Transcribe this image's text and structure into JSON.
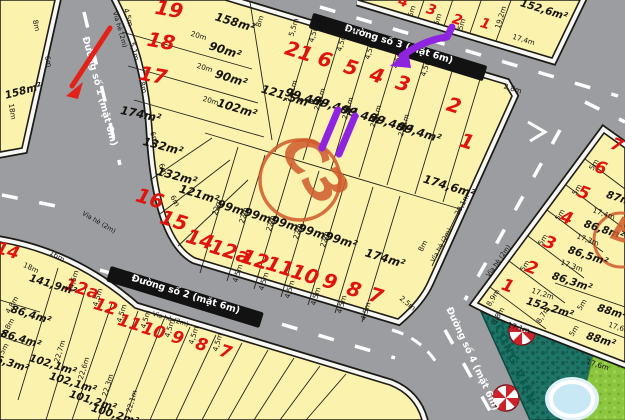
{
  "map_title": "land subdivision plot map",
  "roads": {
    "road1": "Đường số 1 (mặt 6m)",
    "road2": "Đường số 2 (mặt 6m)",
    "road3": "Đường số 3 (mặt 6m)",
    "road4": "Đường số 4 (mặt 6m)",
    "sidewalk": "Vỉa hè (2m)"
  },
  "blocks": {
    "main_block": {
      "label": "C3",
      "plot_numbers": [
        "19",
        "18",
        "17",
        "21",
        "6",
        "5",
        "4",
        "3",
        "2",
        "1",
        "16",
        "15",
        "14",
        "12a",
        "12",
        "11",
        "10",
        "9",
        "8",
        "7"
      ],
      "areas": [
        "158m²",
        "90m²",
        "90m²",
        "102m²",
        "121,5m²",
        "174m²",
        "132m²",
        "132m²",
        "121m²",
        "99,4m²",
        "99,4m²",
        "99,4m²",
        "99,4m²",
        "99,4m²",
        "99m²",
        "99m²",
        "99m²",
        "99m²",
        "99m²",
        "174,6m²",
        "174m²"
      ]
    },
    "block_b": {
      "label": "B",
      "plot_numbers": [
        "7",
        "6",
        "5",
        "4",
        "3",
        "2",
        "1"
      ],
      "areas": [
        "87m²",
        "86,8m²",
        "86,5m²",
        "86,3m²",
        "152,2m²",
        "88m²",
        "88m²"
      ]
    },
    "top_right_block": {
      "plot_numbers": [
        "4",
        "3",
        "2",
        "1"
      ],
      "areas": [
        "152,6m²"
      ]
    },
    "bottom_left_block": {
      "plot_numbers": [
        "14",
        "12a",
        "12",
        "11",
        "10",
        "9",
        "8",
        "7"
      ],
      "areas": [
        "141,9m²",
        "86,4m²",
        "86,4m²",
        "86,3m²",
        "102,1m²",
        "102,1m²",
        "101,2m²",
        "100,2m²"
      ]
    },
    "far_left_block": {
      "areas": [
        "158m²"
      ]
    }
  },
  "park": {
    "name": "CÔNG VIÊN",
    "features": [
      "swimming-pool",
      "parasol",
      "parasol"
    ]
  },
  "annotations": [
    "purple-arrow",
    "purple-double-stroke",
    "red-road-arrow"
  ],
  "colors": {
    "plot_fill": "#faf2ad",
    "road": "#9b9da0",
    "plot_number": "#df140e",
    "block_circle": "#cf5b2c",
    "annotation_purple": "#8e24e0",
    "annotation_red": "#e32119",
    "park_teal": "#1e7466",
    "grass": "#8cc63e",
    "pool": "#c9e8f6"
  },
  "labels": [
    {
      "t": "19",
      "x": 168,
      "y": 16,
      "r": 10,
      "c": "num"
    },
    {
      "t": "18",
      "x": 160,
      "y": 48,
      "r": 10,
      "c": "num"
    },
    {
      "t": "17",
      "x": 152,
      "y": 82,
      "r": 10,
      "c": "num"
    },
    {
      "t": "21",
      "x": 297,
      "y": 58,
      "r": 17,
      "c": "num"
    },
    {
      "t": "6",
      "x": 323,
      "y": 66,
      "r": 17,
      "c": "num"
    },
    {
      "t": "5",
      "x": 349,
      "y": 74,
      "r": 17,
      "c": "num"
    },
    {
      "t": "4",
      "x": 375,
      "y": 82,
      "r": 17,
      "c": "num"
    },
    {
      "t": "3",
      "x": 401,
      "y": 90,
      "r": 17,
      "c": "num"
    },
    {
      "t": "2",
      "x": 452,
      "y": 112,
      "r": 17,
      "c": "num"
    },
    {
      "t": "1",
      "x": 465,
      "y": 148,
      "r": 17,
      "c": "num"
    },
    {
      "t": "16",
      "x": 148,
      "y": 205,
      "r": 17,
      "c": "num"
    },
    {
      "t": "15",
      "x": 172,
      "y": 227,
      "r": 17,
      "c": "num"
    },
    {
      "t": "14",
      "x": 198,
      "y": 246,
      "r": 17,
      "c": "num"
    },
    {
      "t": "12a",
      "x": 228,
      "y": 258,
      "r": 17,
      "c": "num"
    },
    {
      "t": "12",
      "x": 253,
      "y": 266,
      "r": 17,
      "c": "num"
    },
    {
      "t": "11",
      "x": 278,
      "y": 273,
      "r": 17,
      "c": "num"
    },
    {
      "t": "10",
      "x": 303,
      "y": 281,
      "r": 17,
      "c": "num"
    },
    {
      "t": "9",
      "x": 328,
      "y": 288,
      "r": 17,
      "c": "num"
    },
    {
      "t": "8",
      "x": 352,
      "y": 296,
      "r": 17,
      "c": "num"
    },
    {
      "t": "7",
      "x": 374,
      "y": 302,
      "r": 17,
      "c": "num"
    },
    {
      "t": "158m²",
      "x": 234,
      "y": 26,
      "r": 17,
      "c": "area"
    },
    {
      "t": "90m²",
      "x": 224,
      "y": 54,
      "r": 17,
      "c": "area"
    },
    {
      "t": "90m²",
      "x": 230,
      "y": 82,
      "r": 17,
      "c": "area"
    },
    {
      "t": "102m²",
      "x": 236,
      "y": 112,
      "r": 17,
      "c": "area"
    },
    {
      "t": "121,5m²",
      "x": 286,
      "y": 100,
      "r": 17,
      "c": "area"
    },
    {
      "t": "174m²",
      "x": 140,
      "y": 118,
      "r": 12,
      "c": "area"
    },
    {
      "t": "132m²",
      "x": 162,
      "y": 150,
      "r": 15,
      "c": "area"
    },
    {
      "t": "132m²",
      "x": 176,
      "y": 180,
      "r": 15,
      "c": "area"
    },
    {
      "t": "121m²",
      "x": 198,
      "y": 198,
      "r": 17,
      "c": "area"
    },
    {
      "t": "99,4m²",
      "x": 306,
      "y": 102,
      "r": 17,
      "c": "area"
    },
    {
      "t": "99,4m²",
      "x": 334,
      "y": 110,
      "r": 17,
      "c": "area"
    },
    {
      "t": "99,4m²",
      "x": 362,
      "y": 119,
      "r": 17,
      "c": "area"
    },
    {
      "t": "99,4m²",
      "x": 390,
      "y": 127,
      "r": 17,
      "c": "area"
    },
    {
      "t": "99,4m²",
      "x": 418,
      "y": 136,
      "r": 17,
      "c": "area"
    },
    {
      "t": "99m²",
      "x": 232,
      "y": 212,
      "r": 17,
      "c": "area"
    },
    {
      "t": "99m²",
      "x": 259,
      "y": 220,
      "r": 17,
      "c": "area"
    },
    {
      "t": "99m²",
      "x": 286,
      "y": 228,
      "r": 17,
      "c": "area"
    },
    {
      "t": "99m²",
      "x": 313,
      "y": 236,
      "r": 17,
      "c": "area"
    },
    {
      "t": "99m²",
      "x": 340,
      "y": 244,
      "r": 17,
      "c": "area"
    },
    {
      "t": "174,6m²",
      "x": 448,
      "y": 190,
      "r": 17,
      "c": "area"
    },
    {
      "t": "174m²",
      "x": 384,
      "y": 262,
      "r": 17,
      "c": "area"
    },
    {
      "t": "4,5m",
      "x": 126,
      "y": 18,
      "r": 74,
      "c": "dim"
    },
    {
      "t": "5,1m",
      "x": 132,
      "y": 52,
      "r": 74,
      "c": "dim"
    },
    {
      "t": "8m",
      "x": 141,
      "y": 88,
      "r": 74,
      "c": "dim"
    },
    {
      "t": "20m",
      "x": 198,
      "y": 38,
      "r": 17,
      "c": "dim"
    },
    {
      "t": "20m",
      "x": 204,
      "y": 70,
      "r": 17,
      "c": "dim"
    },
    {
      "t": "20m",
      "x": 210,
      "y": 103,
      "r": 17,
      "c": "dim"
    },
    {
      "t": "8m",
      "x": 262,
      "y": 22,
      "r": -73,
      "c": "dim"
    },
    {
      "t": "5,5m",
      "x": 296,
      "y": 28,
      "r": -73,
      "c": "dim"
    },
    {
      "t": "4,5m",
      "x": 316,
      "y": 34,
      "r": -73,
      "c": "dim"
    },
    {
      "t": "4,5m",
      "x": 344,
      "y": 43,
      "r": -73,
      "c": "dim"
    },
    {
      "t": "4,5m",
      "x": 372,
      "y": 51,
      "r": -73,
      "c": "dim"
    },
    {
      "t": "4,5m",
      "x": 400,
      "y": 60,
      "r": -73,
      "c": "dim"
    },
    {
      "t": "4,5m",
      "x": 428,
      "y": 68,
      "r": -73,
      "c": "dim"
    },
    {
      "t": "22,1m",
      "x": 294,
      "y": 92,
      "r": -73,
      "c": "dim"
    },
    {
      "t": "22,1m",
      "x": 322,
      "y": 100,
      "r": -73,
      "c": "dim"
    },
    {
      "t": "22,1m",
      "x": 350,
      "y": 109,
      "r": -73,
      "c": "dim"
    },
    {
      "t": "22,1m",
      "x": 378,
      "y": 117,
      "r": -73,
      "c": "dim"
    },
    {
      "t": "22,1m",
      "x": 406,
      "y": 126,
      "r": -73,
      "c": "dim"
    },
    {
      "t": "22m",
      "x": 219,
      "y": 208,
      "r": -73,
      "c": "dim"
    },
    {
      "t": "22m",
      "x": 246,
      "y": 216,
      "r": -73,
      "c": "dim"
    },
    {
      "t": "22m",
      "x": 273,
      "y": 224,
      "r": -73,
      "c": "dim"
    },
    {
      "t": "22m",
      "x": 300,
      "y": 232,
      "r": -73,
      "c": "dim"
    },
    {
      "t": "22m",
      "x": 327,
      "y": 240,
      "r": -73,
      "c": "dim"
    },
    {
      "t": "4,5m",
      "x": 240,
      "y": 274,
      "r": -73,
      "c": "dim"
    },
    {
      "t": "4,5m",
      "x": 266,
      "y": 282,
      "r": -73,
      "c": "dim"
    },
    {
      "t": "4,5m",
      "x": 292,
      "y": 290,
      "r": -73,
      "c": "dim"
    },
    {
      "t": "4,5m",
      "x": 318,
      "y": 297,
      "r": -73,
      "c": "dim"
    },
    {
      "t": "4,5m",
      "x": 344,
      "y": 305,
      "r": -73,
      "c": "dim"
    },
    {
      "t": "4,5m",
      "x": 368,
      "y": 312,
      "r": -73,
      "c": "dim"
    },
    {
      "t": "6m",
      "x": 152,
      "y": 138,
      "r": 70,
      "c": "dim"
    },
    {
      "t": "6m",
      "x": 161,
      "y": 170,
      "r": 66,
      "c": "dim"
    },
    {
      "t": "6m",
      "x": 173,
      "y": 202,
      "r": 60,
      "c": "dim"
    },
    {
      "t": "2,5m",
      "x": 406,
      "y": 305,
      "r": 40,
      "c": "dim"
    },
    {
      "t": "2,8m",
      "x": 512,
      "y": 91,
      "r": 17,
      "c": "dim"
    },
    {
      "t": "20,1m",
      "x": 464,
      "y": 206,
      "r": -62,
      "c": "dim"
    },
    {
      "t": "8m",
      "x": 425,
      "y": 247,
      "r": -62,
      "c": "dim"
    },
    {
      "t": "158m²",
      "x": 24,
      "y": 94,
      "r": -15,
      "c": "area2"
    },
    {
      "t": "18m",
      "x": 10,
      "y": 112,
      "r": 80,
      "c": "dim"
    },
    {
      "t": "8m",
      "x": 34,
      "y": 26,
      "r": 78,
      "c": "dim"
    },
    {
      "t": "6m",
      "x": 46,
      "y": 62,
      "r": 78,
      "c": "dim"
    },
    {
      "t": "4",
      "x": 402,
      "y": 6,
      "r": 17,
      "c": "num3"
    },
    {
      "t": "3",
      "x": 430,
      "y": 14,
      "r": 17,
      "c": "num3"
    },
    {
      "t": "2",
      "x": 456,
      "y": 24,
      "r": 17,
      "c": "num3"
    },
    {
      "t": "1",
      "x": 484,
      "y": 28,
      "r": 17,
      "c": "num3"
    },
    {
      "t": "5m",
      "x": 414,
      "y": 12,
      "r": -73,
      "c": "dim"
    },
    {
      "t": "5m",
      "x": 440,
      "y": 20,
      "r": -73,
      "c": "dim"
    },
    {
      "t": "5m",
      "x": 464,
      "y": 25,
      "r": -73,
      "c": "dim"
    },
    {
      "t": "19,2m",
      "x": 503,
      "y": 18,
      "r": -73,
      "c": "dim"
    },
    {
      "t": "17,4m",
      "x": 523,
      "y": 42,
      "r": 17,
      "c": "dim"
    },
    {
      "t": "152,6m²",
      "x": 543,
      "y": 13,
      "r": 17,
      "c": "area2"
    },
    {
      "t": "7",
      "x": 615,
      "y": 150,
      "r": 20,
      "c": "num2"
    },
    {
      "t": "6",
      "x": 599,
      "y": 173,
      "r": 20,
      "c": "num2"
    },
    {
      "t": "5",
      "x": 582,
      "y": 198,
      "r": 20,
      "c": "num2"
    },
    {
      "t": "4",
      "x": 565,
      "y": 223,
      "r": 20,
      "c": "num2"
    },
    {
      "t": "3",
      "x": 548,
      "y": 248,
      "r": 20,
      "c": "num2"
    },
    {
      "t": "2",
      "x": 530,
      "y": 273,
      "r": 20,
      "c": "num2"
    },
    {
      "t": "1",
      "x": 506,
      "y": 291,
      "r": 20,
      "c": "num2"
    },
    {
      "t": "5m",
      "x": 596,
      "y": 166,
      "r": -58,
      "c": "dim"
    },
    {
      "t": "5m",
      "x": 579,
      "y": 191,
      "r": -58,
      "c": "dim"
    },
    {
      "t": "5m",
      "x": 562,
      "y": 216,
      "r": -58,
      "c": "dim"
    },
    {
      "t": "5m",
      "x": 545,
      "y": 241,
      "r": -58,
      "c": "dim"
    },
    {
      "t": "5m",
      "x": 527,
      "y": 267,
      "r": -58,
      "c": "dim"
    },
    {
      "t": "17,4m",
      "x": 603,
      "y": 216,
      "r": 20,
      "c": "dim"
    },
    {
      "t": "17,3m",
      "x": 587,
      "y": 242,
      "r": 20,
      "c": "dim"
    },
    {
      "t": "17,3m",
      "x": 571,
      "y": 268,
      "r": 20,
      "c": "dim"
    },
    {
      "t": "17,2m",
      "x": 542,
      "y": 296,
      "r": 18,
      "c": "dim"
    },
    {
      "t": "17,1m",
      "x": 518,
      "y": 330,
      "r": 17,
      "c": "dim"
    },
    {
      "t": "8,9m",
      "x": 495,
      "y": 299,
      "r": -58,
      "c": "dim"
    },
    {
      "t": "8,7m",
      "x": 545,
      "y": 316,
      "r": -58,
      "c": "dim"
    },
    {
      "t": "3,8m",
      "x": 500,
      "y": 317,
      "r": -58,
      "c": "dim"
    },
    {
      "t": "5m",
      "x": 584,
      "y": 306,
      "r": -58,
      "c": "dim"
    },
    {
      "t": "5m",
      "x": 576,
      "y": 332,
      "r": -58,
      "c": "dim"
    },
    {
      "t": "17,6m",
      "x": 619,
      "y": 330,
      "r": 17,
      "c": "dim"
    },
    {
      "t": "17,6m",
      "x": 597,
      "y": 367,
      "r": 17,
      "c": "dim"
    },
    {
      "t": "87m²",
      "x": 620,
      "y": 202,
      "r": 18,
      "c": "area2"
    },
    {
      "t": "86,8m²",
      "x": 603,
      "y": 233,
      "r": 18,
      "c": "area2"
    },
    {
      "t": "86,5m²",
      "x": 587,
      "y": 259,
      "r": 18,
      "c": "area2"
    },
    {
      "t": "86,3m²",
      "x": 571,
      "y": 285,
      "r": 18,
      "c": "area2"
    },
    {
      "t": "152,2m²",
      "x": 549,
      "y": 311,
      "r": 17,
      "c": "area2"
    },
    {
      "t": "88m²",
      "x": 611,
      "y": 315,
      "r": 17,
      "c": "area2"
    },
    {
      "t": "88m²",
      "x": 600,
      "y": 343,
      "r": 17,
      "c": "area2"
    },
    {
      "t": "14",
      "x": 6,
      "y": 256,
      "r": 17,
      "c": "num2"
    },
    {
      "t": "12a",
      "x": 80,
      "y": 294,
      "r": 17,
      "c": "num2"
    },
    {
      "t": "12",
      "x": 104,
      "y": 312,
      "r": 17,
      "c": "num2"
    },
    {
      "t": "11",
      "x": 128,
      "y": 328,
      "r": 17,
      "c": "num2"
    },
    {
      "t": "10",
      "x": 152,
      "y": 336,
      "r": 17,
      "c": "num2"
    },
    {
      "t": "9",
      "x": 176,
      "y": 343,
      "r": 17,
      "c": "num2"
    },
    {
      "t": "8",
      "x": 200,
      "y": 350,
      "r": 17,
      "c": "num2"
    },
    {
      "t": "7",
      "x": 224,
      "y": 357,
      "r": 17,
      "c": "num2"
    },
    {
      "t": "4,5m",
      "x": 76,
      "y": 280,
      "r": -73,
      "c": "dim"
    },
    {
      "t": "4,5m",
      "x": 100,
      "y": 298,
      "r": -73,
      "c": "dim"
    },
    {
      "t": "4,5m",
      "x": 124,
      "y": 314,
      "r": -73,
      "c": "dim"
    },
    {
      "t": "4,5m",
      "x": 148,
      "y": 320,
      "r": -73,
      "c": "dim"
    },
    {
      "t": "4,5m",
      "x": 172,
      "y": 329,
      "r": -73,
      "c": "dim"
    },
    {
      "t": "4,5m",
      "x": 196,
      "y": 336,
      "r": -73,
      "c": "dim"
    },
    {
      "t": "4,5m",
      "x": 220,
      "y": 343,
      "r": -73,
      "c": "dim"
    },
    {
      "t": "22,7m",
      "x": 62,
      "y": 352,
      "r": -73,
      "c": "dim"
    },
    {
      "t": "22,6m",
      "x": 86,
      "y": 369,
      "r": -73,
      "c": "dim"
    },
    {
      "t": "22,3m",
      "x": 110,
      "y": 386,
      "r": -73,
      "c": "dim"
    },
    {
      "t": "22,1m",
      "x": 134,
      "y": 402,
      "r": -73,
      "c": "dim"
    },
    {
      "t": "4,8m",
      "x": 14,
      "y": 306,
      "r": -60,
      "c": "dim"
    },
    {
      "t": "4,8m",
      "x": 10,
      "y": 328,
      "r": -60,
      "c": "dim"
    },
    {
      "t": "5m",
      "x": 6,
      "y": 350,
      "r": -60,
      "c": "dim"
    },
    {
      "t": "18m",
      "x": 30,
      "y": 270,
      "r": 25,
      "c": "dim"
    },
    {
      "t": "16m",
      "x": 56,
      "y": 258,
      "r": 32,
      "c": "dim"
    },
    {
      "t": "141,9m²",
      "x": 52,
      "y": 288,
      "r": 17,
      "c": "area2"
    },
    {
      "t": "86,4m²",
      "x": 30,
      "y": 318,
      "r": 17,
      "c": "area2"
    },
    {
      "t": "86,4m²",
      "x": 20,
      "y": 342,
      "r": 17,
      "c": "area2"
    },
    {
      "t": "86,3m²",
      "x": 8,
      "y": 366,
      "r": 17,
      "c": "area2"
    },
    {
      "t": "102,1m²",
      "x": 52,
      "y": 368,
      "r": 17,
      "c": "area2"
    },
    {
      "t": "102,1m²",
      "x": 72,
      "y": 386,
      "r": 17,
      "c": "area2"
    },
    {
      "t": "101,2m²",
      "x": 92,
      "y": 404,
      "r": 17,
      "c": "area2"
    },
    {
      "t": "100,2m²",
      "x": 114,
      "y": 418,
      "r": 17,
      "c": "area2"
    },
    {
      "t": "Đường số 3 (mặt 6m)",
      "x": 398,
      "y": 47,
      "r": 17,
      "c": "road"
    },
    {
      "t": "Đường số 2 (mặt 6m)",
      "x": 185,
      "y": 297,
      "r": 17,
      "c": "road"
    },
    {
      "t": "Đường số 1 (mặt 6m)",
      "x": 97,
      "y": 92,
      "r": 75,
      "c": "roadw"
    },
    {
      "t": "Đường số 4 (mặt 6m)",
      "x": 470,
      "y": 360,
      "r": 65,
      "c": "roadw"
    },
    {
      "t": "Vỉa hè (2m)",
      "x": 118,
      "y": 30,
      "r": 74,
      "c": "side"
    },
    {
      "t": "Vỉa hè (2m)",
      "x": 340,
      "y": 30,
      "r": 17,
      "c": "side"
    },
    {
      "t": "Vỉa hè (2m)",
      "x": 443,
      "y": 246,
      "r": -62,
      "c": "side"
    },
    {
      "t": "Vỉa hè (2m)",
      "x": 500,
      "y": 262,
      "r": -55,
      "c": "side"
    },
    {
      "t": "Vỉa hè (2m)",
      "x": 170,
      "y": 321,
      "r": 17,
      "c": "side"
    },
    {
      "t": "Vỉa hè (2m)",
      "x": 98,
      "y": 224,
      "r": 30,
      "c": "side"
    },
    {
      "t": "C3",
      "x": 300,
      "y": 180,
      "r": 55,
      "c": "blk"
    },
    {
      "t": "B",
      "x": 621,
      "y": 242,
      "r": 20,
      "c": "blk2"
    },
    {
      "t": "CÔNG VIÊN",
      "x": 512,
      "y": 366,
      "r": 66,
      "c": "park"
    }
  ]
}
